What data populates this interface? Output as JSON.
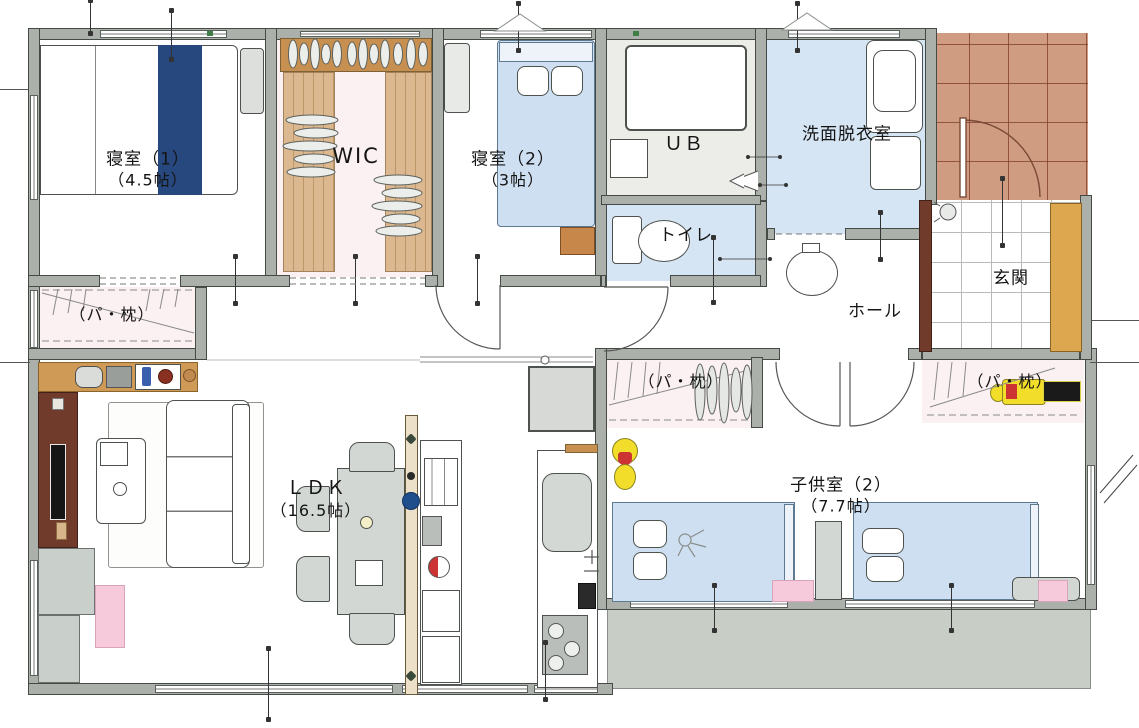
{
  "meta": {
    "title": "間取り図（平面図）"
  },
  "colors": {
    "wall": "#abb0ab",
    "floor_blue": "#d6e5f3",
    "floor_ub": "#ecede9",
    "floor_pink": "#fbf0f2",
    "tile_porch": "#cf9c82",
    "tile_line": "#8e5a43",
    "wood": "#dcb890",
    "shelf_tan": "#c89050",
    "cabinet_tan": "#dca74e",
    "deck": "#c8cdc5",
    "bed_blue": "#cfdff2",
    "accent_navy": "#27487e",
    "tv_brown": "#703b2b",
    "mat_pink": "#f6cadb",
    "furn_gray": "#d2d7d3",
    "toy_yellow": "#f2dd2a",
    "toy_red": "#cc3333"
  },
  "rooms": {
    "bedroom1": {
      "name": "寝室（1）",
      "size": "（4.5帖）"
    },
    "wic": {
      "name": "WIC"
    },
    "bedroom2": {
      "name": "寝室（2）",
      "size": "（3帖）"
    },
    "unit_bath": {
      "name": "ＵＢ"
    },
    "washroom": {
      "name": "洗面脱衣室"
    },
    "toilet": {
      "name": "トイレ"
    },
    "entrance": {
      "name": "玄関"
    },
    "hall": {
      "name": "ホール"
    },
    "ldk": {
      "name": "ＬＤＫ",
      "size": "（16.5帖）"
    },
    "kids_room": {
      "name": "子供室（2）",
      "size": "（7.7帖）"
    },
    "closet_left": {
      "name": "（パ・枕）"
    },
    "closet_kids_a": {
      "name": "（パ・枕）"
    },
    "closet_kids_b": {
      "name": "（パ・枕）"
    }
  }
}
